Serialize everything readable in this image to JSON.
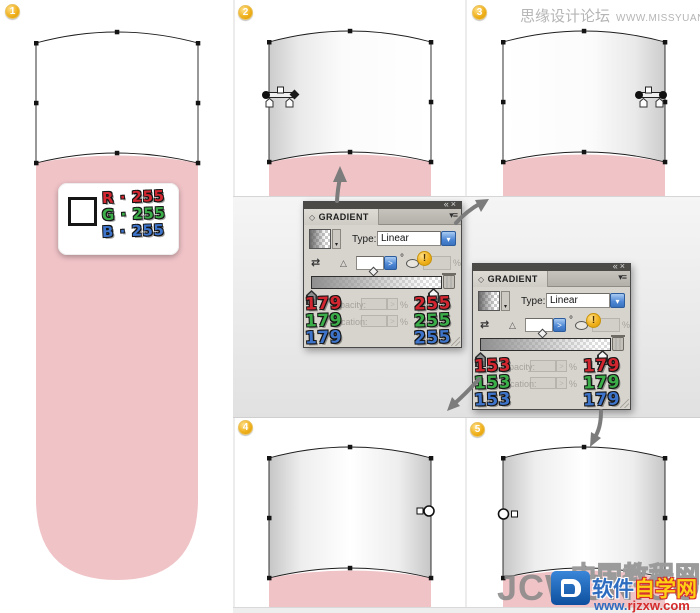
{
  "watermark_top": {
    "site": "思缘设计论坛",
    "url": "WWW.MISSYUAN.COM"
  },
  "badges": {
    "s1": "1",
    "s2": "2",
    "s3": "3",
    "s4": "4",
    "s5": "5"
  },
  "rgb_card": {
    "r_label": "R · 255",
    "g_label": "G · 255",
    "b_label": "B · 255"
  },
  "panels": [
    {
      "collapse_icon": "«",
      "close_icon": "×",
      "tab_icon": "◇",
      "tab_title": "GRADIENT",
      "menu_icon": "▾≡",
      "type_label": "Type:",
      "type_value": "Linear",
      "dropdown_arrow": "▾",
      "reverse_icon": "⇄",
      "angle_icon": "△",
      "spinner_arrow": ">",
      "degree": "°",
      "percent": "%",
      "alert": "!",
      "opacity_label": "Opacity:",
      "location_label": "Location:",
      "left_stop_rgb": [
        "179",
        "179",
        "179"
      ],
      "right_stop_rgb": [
        "255",
        "255",
        "255"
      ]
    },
    {
      "collapse_icon": "«",
      "close_icon": "×",
      "tab_icon": "◇",
      "tab_title": "GRADIENT",
      "menu_icon": "▾≡",
      "type_label": "Type:",
      "type_value": "Linear",
      "dropdown_arrow": "▾",
      "reverse_icon": "⇄",
      "angle_icon": "△",
      "spinner_arrow": ">",
      "degree": "°",
      "percent": "%",
      "alert": "!",
      "opacity_label": "Opacity:",
      "location_label": "Location:",
      "left_stop_rgb": [
        "153",
        "153",
        "153"
      ],
      "right_stop_rgb": [
        "179",
        "179",
        "179"
      ]
    }
  ],
  "watermark_bottom": {
    "jcw": "JCWCN.COM",
    "outline_site": "中国教程网",
    "site_blue": "软件",
    "site_yellow": "自学网",
    "url_www": "www.",
    "url_domain": "rjzxw.com"
  },
  "colors": {
    "pink": "#f0c3c7",
    "panel_bg": "#d7d4ce",
    "panel_header": "#4b4a47",
    "badge_gold": "#f0b11d",
    "combo_blue": "#4c86d4",
    "arrow_gray": "#7c7c7c",
    "num_red": "#d22730",
    "num_green": "#3cae49",
    "num_blue": "#3e74c9",
    "watermark_gray": "#b5b5b5"
  }
}
